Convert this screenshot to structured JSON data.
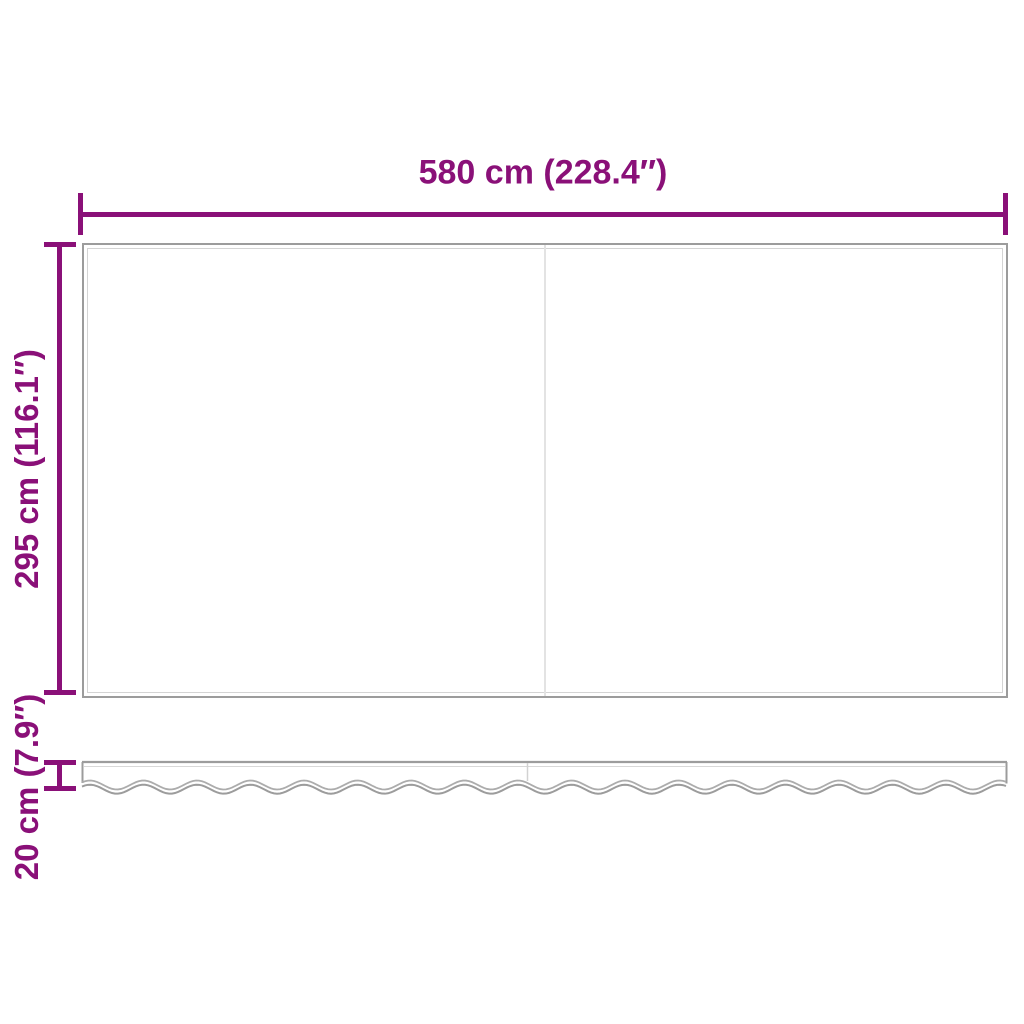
{
  "diagram": {
    "type": "awning-replacement-fabric-dimension-diagram",
    "width_dimension": {
      "label": "580 cm (228.4″)"
    },
    "height_dimension": {
      "label": "295 cm (116.1″)"
    },
    "valance_dimension": {
      "label": "20 cm (7.9″)"
    },
    "colors": {
      "dimension_accent": "#8A1078",
      "fabric_outline": "#9C9C9C",
      "fabric_hem": "#D4D4D4",
      "seam": "#E3E3E3",
      "background": "#FFFFFF"
    }
  }
}
